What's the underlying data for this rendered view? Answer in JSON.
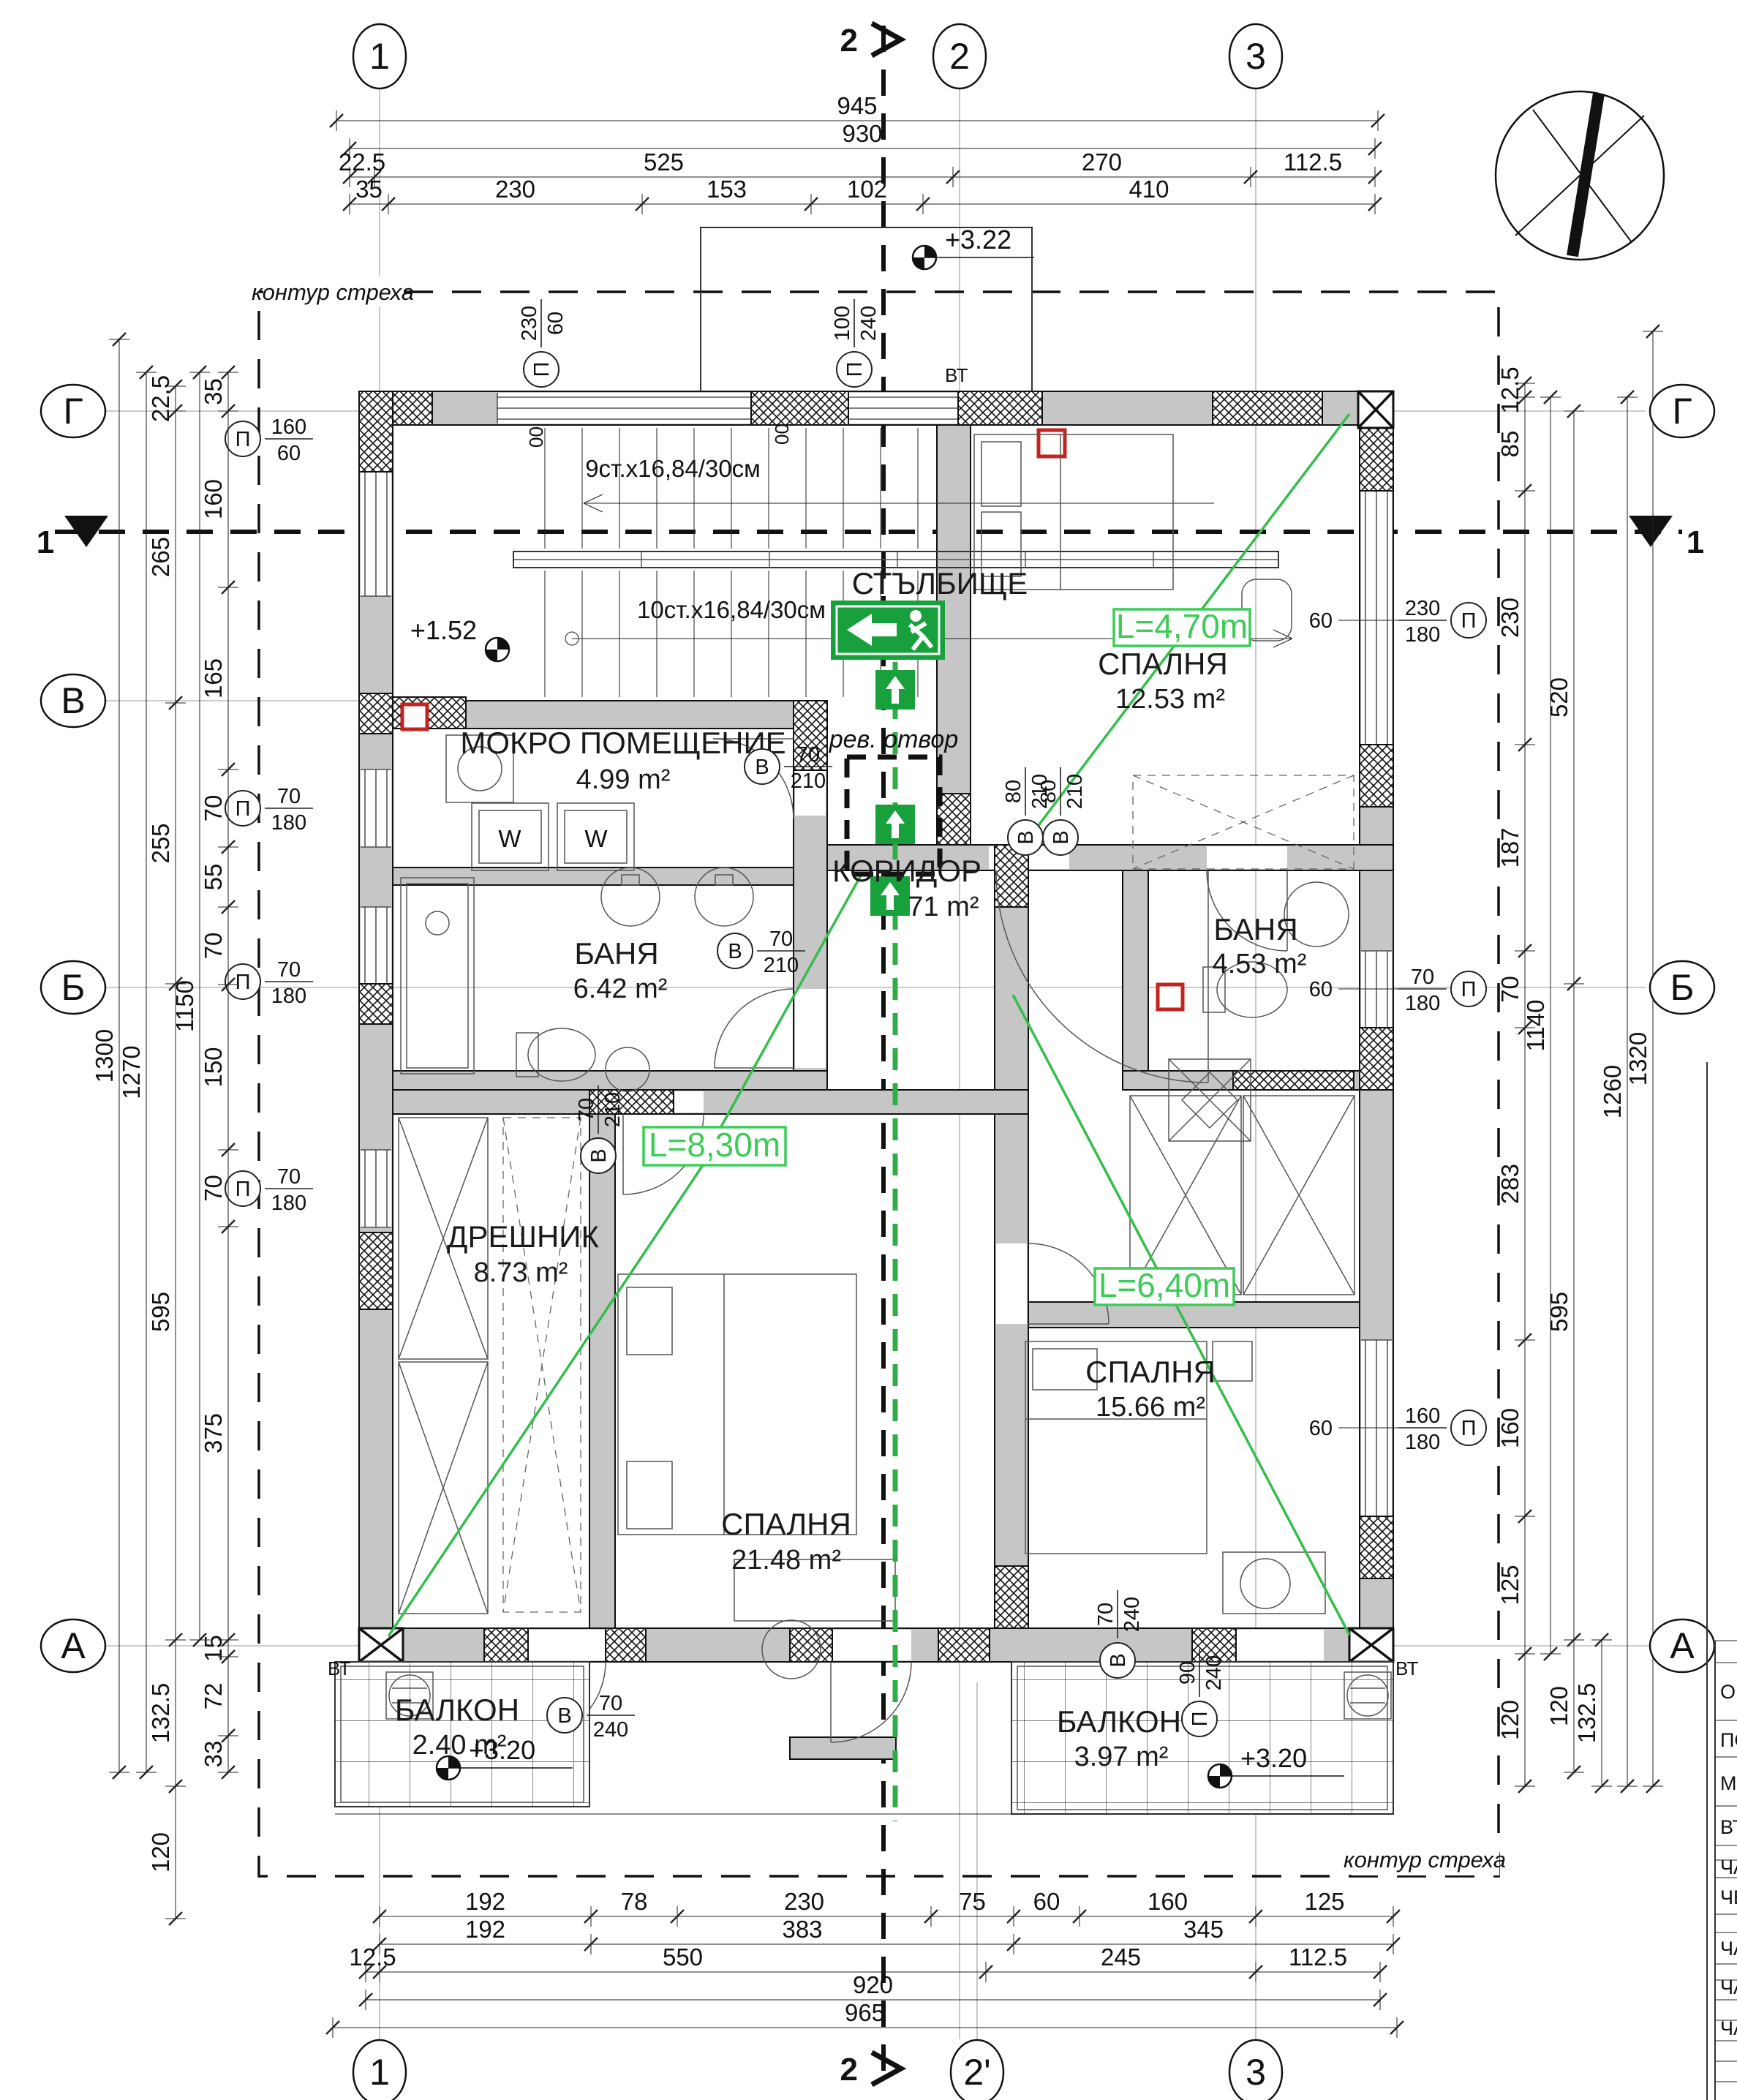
{
  "grid_axes": {
    "top": [
      "1",
      "2",
      "3"
    ],
    "bottom": [
      "1",
      "2'",
      "3"
    ],
    "left": [
      "Г",
      "В",
      "Б",
      "А"
    ],
    "right": [
      "Г",
      "Б",
      "А"
    ],
    "section_h": "1",
    "section_v": "2"
  },
  "eaves_label": "контур стреха",
  "rooms": [
    {
      "name": "СТЪЛБИЩЕ",
      "area": ""
    },
    {
      "name": "МОКРО ПОМЕЩЕНИЕ",
      "area": "4.99 m²"
    },
    {
      "name": "СПАЛНЯ",
      "area": "12.53 m²"
    },
    {
      "name": "КОРИДОР",
      "area": "71 m²"
    },
    {
      "name": "БАНЯ",
      "area": "6.42 m²"
    },
    {
      "name": "БАНЯ",
      "area": "4.53 m²"
    },
    {
      "name": "ДРЕШНИК",
      "area": "8.73 m²"
    },
    {
      "name": "СПАЛНЯ",
      "area": "21.48 m²"
    },
    {
      "name": "СПАЛНЯ",
      "area": "15.66 m²"
    },
    {
      "name": "БАЛКОН",
      "area": "2.40 m²"
    },
    {
      "name": "БАЛКОН",
      "area": "3.97 m²"
    }
  ],
  "stairs": {
    "upper": "9ст.x16,84/30см",
    "lower": "10ст.x16,84/30см",
    "wall_mark": "00"
  },
  "levels": {
    "roof": "+3.22",
    "landing": "+1.52",
    "balcony_left": "+3.20",
    "balcony_right": "+3.20"
  },
  "escape": {
    "l1": "L=4,70m",
    "l2": "L=8,30m",
    "l3": "L=6,40m"
  },
  "revision_opening": "рев. отвор",
  "vent": "ВТ",
  "washer_label": "W",
  "openings": [
    {
      "tag": "П",
      "size": "160/60"
    },
    {
      "tag": "П",
      "size": "70/180"
    },
    {
      "tag": "П",
      "size": "70/180"
    },
    {
      "tag": "П",
      "size": "70/180"
    },
    {
      "tag": "П",
      "size": "230/60"
    },
    {
      "tag": "П",
      "size": "100/240"
    },
    {
      "tag": "П",
      "size": "230/180",
      "sill": "60"
    },
    {
      "tag": "П",
      "size": "70/180",
      "sill": "60"
    },
    {
      "tag": "П",
      "size": "160/180",
      "sill": "60"
    },
    {
      "tag": "В",
      "size": "70/210"
    },
    {
      "tag": "В",
      "size": "80/210"
    },
    {
      "tag": "В",
      "size": "80/210"
    },
    {
      "tag": "В",
      "size": "70/210"
    },
    {
      "tag": "В",
      "size": "70/210"
    },
    {
      "tag": "В",
      "size": "70/240"
    },
    {
      "tag": "П",
      "size": "90/240"
    },
    {
      "tag": "В",
      "size": "70/240"
    }
  ],
  "dims": {
    "top_r1": [
      "945"
    ],
    "top_r2": [
      "930"
    ],
    "top_r3": [
      "22.5",
      "525",
      "270",
      "112.5"
    ],
    "top_r4": [
      "35",
      "230",
      "153",
      "102",
      "410"
    ],
    "bot_r1": [
      "192",
      "78",
      "230",
      "75",
      "60",
      "160",
      "125"
    ],
    "bot_r2": [
      "192",
      "383",
      "345"
    ],
    "bot_r3": [
      "12.5",
      "550",
      "245",
      "112.5"
    ],
    "bot_r4": [
      "920"
    ],
    "bot_r5": [
      "965"
    ],
    "left_c1": [
      "35",
      "160",
      "165",
      "70",
      "55",
      "70",
      "150",
      "70",
      "375",
      "15",
      "72",
      "33"
    ],
    "left_c2": [
      "22.5",
      "265",
      "255",
      "595",
      "132.5",
      "120"
    ],
    "left_c3": [
      "1150"
    ],
    "left_c4": [
      "1270"
    ],
    "left_c5": [
      "1300"
    ],
    "right_c1": [
      "12.5",
      "85",
      "230",
      "187",
      "70",
      "283",
      "160",
      "125",
      "120"
    ],
    "right_c2": [
      "520",
      "595",
      "120"
    ],
    "right_c3": [
      "132.5"
    ],
    "right_c4": [
      "1140"
    ],
    "right_c5": [
      "1260"
    ],
    "right_c6": [
      "1320"
    ]
  },
  "title_block": {
    "rows": [
      "ОБЕ",
      "ПОД",
      "МЕС",
      "ВЪЗ",
      "ЧАС",
      "ЧЕР",
      "ЧАС",
      "ЧАС",
      "ЧАС"
    ]
  },
  "colors": {
    "green": "#2fae48",
    "wall_gray": "#c6c6c6",
    "red": "#c4241f"
  }
}
